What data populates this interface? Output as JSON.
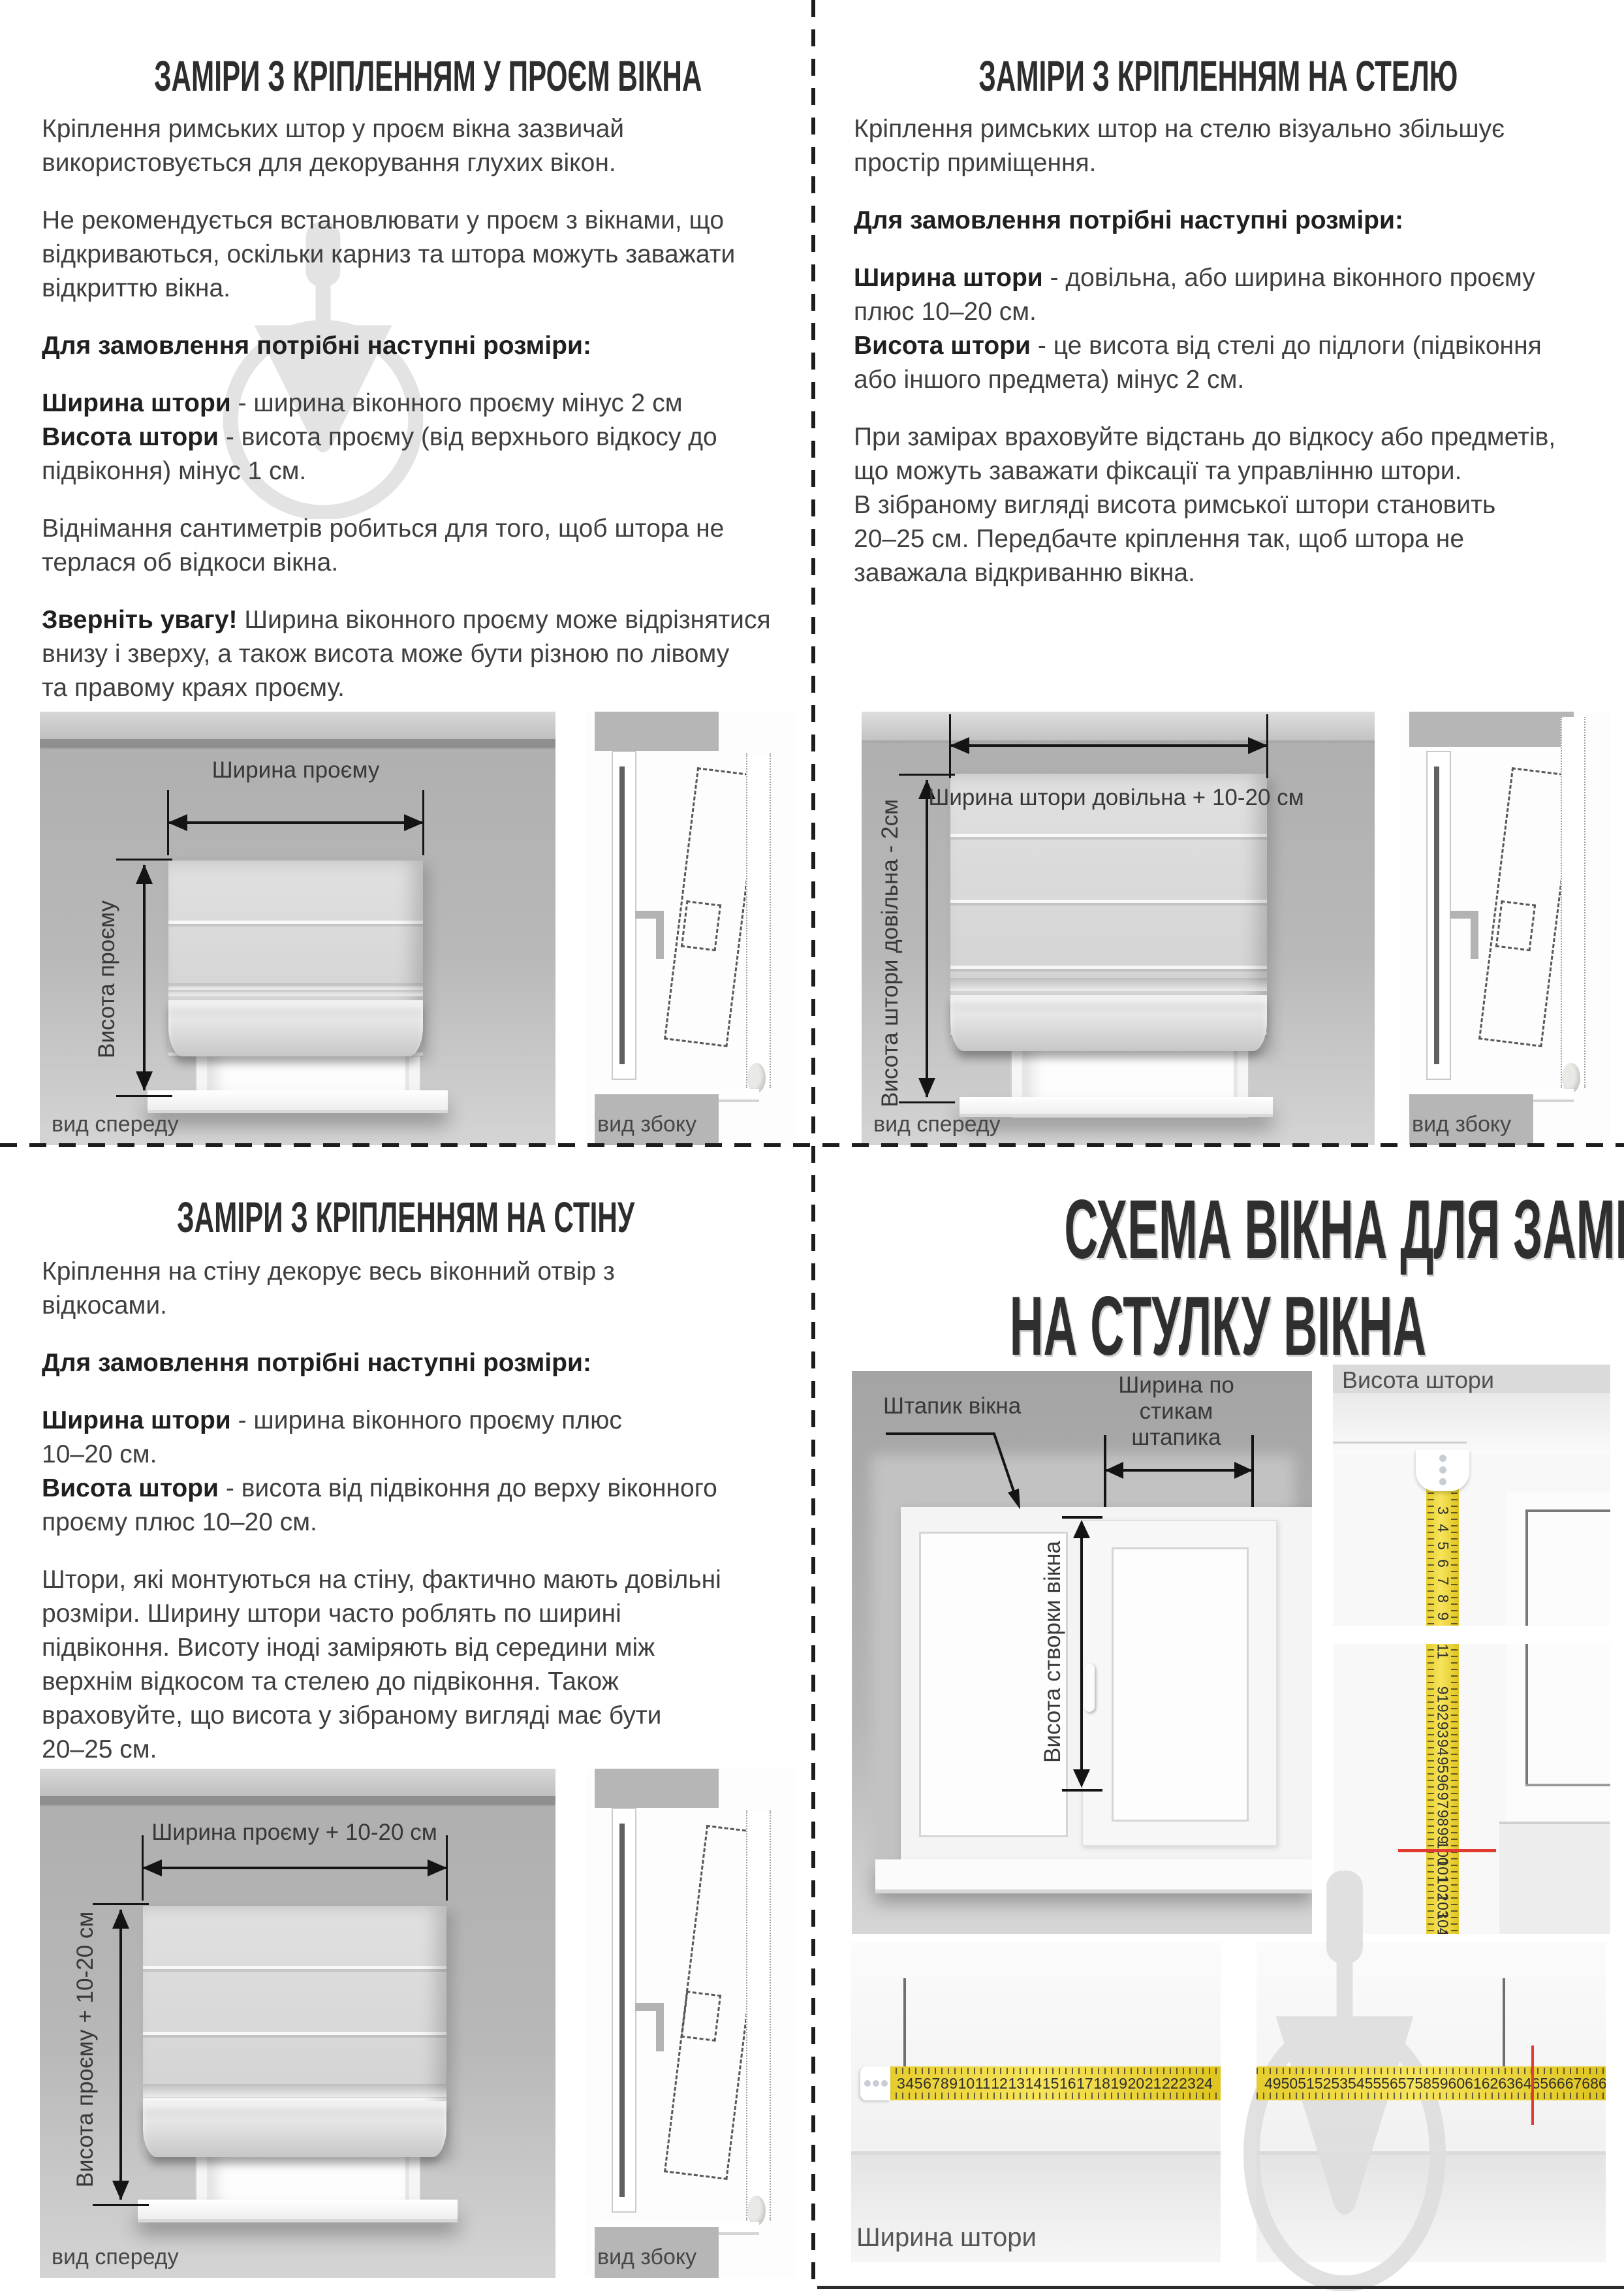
{
  "q1": {
    "title": "ЗАМІРИ З КРІПЛЕННЯМ У ПРОЄМ ВІКНА",
    "p1": "Кріплення римських штор у проєм вікна зазвичай\nвикористовується для декорування глухих вікон.",
    "p2": "Не рекомендується встановлювати у проєм з вікнами, що\nвідкриваються, оскільки карниз та штора можуть заважати\nвідкриттю вікна.",
    "order_heading": "Для замовлення потрібні наступні розміри:",
    "width_term": "Ширина штори",
    "width_def": " - ширина віконного проєму мінус 2 см",
    "height_term": "Висота штори",
    "height_def": " - висота проєму (від верхнього відкосу до\nпідвіконня) мінус 1 см.",
    "p3": "Віднімання сантиметрів робиться для того, щоб штора не\nтерлася об відкоси вікна.",
    "note_term": "Зверніть увагу!",
    "note_rest": " Ширина віконного проєму може відрізнятися\nвнизу і зверху, а також висота може бути різною по лівому\nта правому краях проєму.",
    "diagram": {
      "width_label": "Ширина проєму",
      "height_label": "Висота проєму",
      "front_label": "вид спереду",
      "side_label": "вид збоку"
    }
  },
  "q2": {
    "title": "ЗАМІРИ З КРІПЛЕННЯМ НА СТЕЛЮ",
    "p1": "Кріплення римських штор на стелю візуально збільшує\nпростір приміщення.",
    "order_heading": "Для замовлення потрібні наступні розміри:",
    "width_term": "Ширина штори",
    "width_def": " - довільна, або ширина віконного проєму\nплюс 10–20 см.",
    "height_term": "Висота штори",
    "height_def": " - це висота від стелі до підлоги (підвіконня\nабо іншого предмета) мінус 2 см.",
    "p2": "При замірах враховуйте відстань до відкосу або предметів,\nщо можуть заважати фіксації та управлінню штори.\nВ зібраному вигляді висота римської штори становить\n20–25 см. Передбачте кріплення так, щоб штора не\nзаважала відкриванню вікна.",
    "diagram": {
      "width_label": "Ширина штори довільна + 10-20 см",
      "height_label": "Висота штори довільна - 2см",
      "front_label": "вид спереду",
      "side_label": "вид збоку"
    }
  },
  "q3": {
    "title": "ЗАМІРИ З КРІПЛЕННЯМ НА СТІНУ",
    "p1": "Кріплення на стіну декорує весь віконний отвір з\nвідкосами.",
    "order_heading": "Для замовлення потрібні наступні розміри:",
    "width_term": "Ширина штори",
    "width_def": " - ширина віконного проєму плюс\n10–20 см.",
    "height_term": "Висота штори",
    "height_def": " - висота від підвіконня до верху віконного\nпроєму плюс 10–20 см.",
    "p2": "Штори, які монтуються на стіну, фактично мають довільні\nрозміри. Ширину штори часто роблять по ширині\nпідвіконня. Висоту іноді заміряють від середини між\nверхнім відкосом та стелею до підвіконня. Також\nвраховуйте, що висота у зібраному вигляді має бути\n20–25 см.",
    "diagram": {
      "width_label": "Ширина проєму + 10-20 см",
      "height_label": "Висота проєму + 10-20 см",
      "front_label": "вид спереду",
      "side_label": "вид збоку"
    }
  },
  "q4": {
    "title_line1": "СХЕМА ВІКНА ДЛЯ ЗАМІРІВ",
    "title_line2": "НА СТУЛКУ ВІКНА",
    "bead_label": "Штапик вікна",
    "bead_width_label": "Ширина по стикам\nштапика",
    "sash_height_label": "Висота створки вікна",
    "curtain_height_label": "Висота штори",
    "curtain_width_label": "Ширина штори",
    "tape_vertical": {
      "top_numbers": [
        3,
        4,
        5,
        6,
        7,
        8,
        9,
        10,
        11
      ],
      "bottom_numbers": [
        91,
        92,
        93,
        94,
        95,
        96,
        97,
        98,
        99,
        100,
        101,
        102,
        103,
        104,
        105,
        106,
        107,
        108,
        109,
        110
      ],
      "red_mark_at": 104
    },
    "tape_horizontal": {
      "left_numbers": [
        3,
        4,
        5,
        6,
        7,
        8,
        9,
        10,
        11,
        12,
        13,
        14,
        15,
        16,
        17,
        18,
        19,
        20,
        21,
        22,
        23,
        24
      ],
      "right_numbers": [
        49,
        50,
        51,
        52,
        53,
        54,
        55,
        56,
        57,
        58,
        59,
        60,
        61,
        62,
        63,
        64,
        65,
        66,
        67,
        68,
        69,
        70,
        71,
        72,
        73,
        74,
        75,
        76,
        77,
        78,
        79
      ],
      "red_mark_at": 73
    }
  }
}
